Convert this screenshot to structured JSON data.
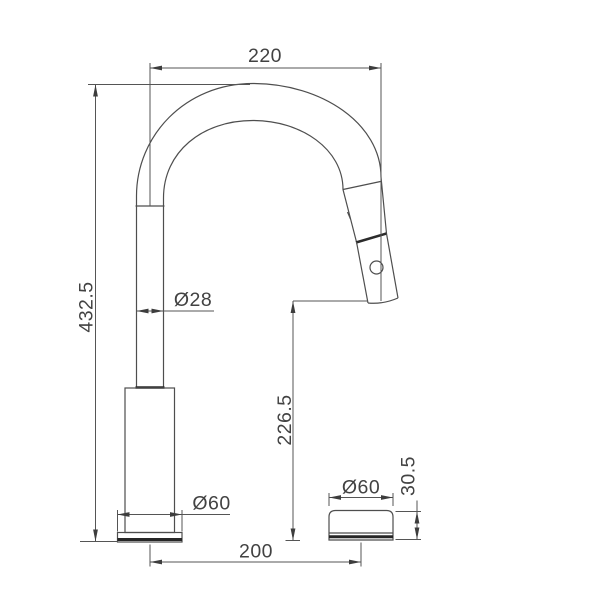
{
  "drawing": {
    "background": "#ffffff",
    "line_color": "#4e4e4e",
    "dark_line_color": "#262626",
    "text_color": "#424242",
    "labels": {
      "spout_reach": "220",
      "overall_height": "432.5",
      "tube_diameter": "Ø28",
      "outlet_height": "226.5",
      "base_diameter": "Ø60",
      "handle_diameter": "Ø60",
      "handle_height": "30.5",
      "hole_spacing": "200"
    }
  }
}
